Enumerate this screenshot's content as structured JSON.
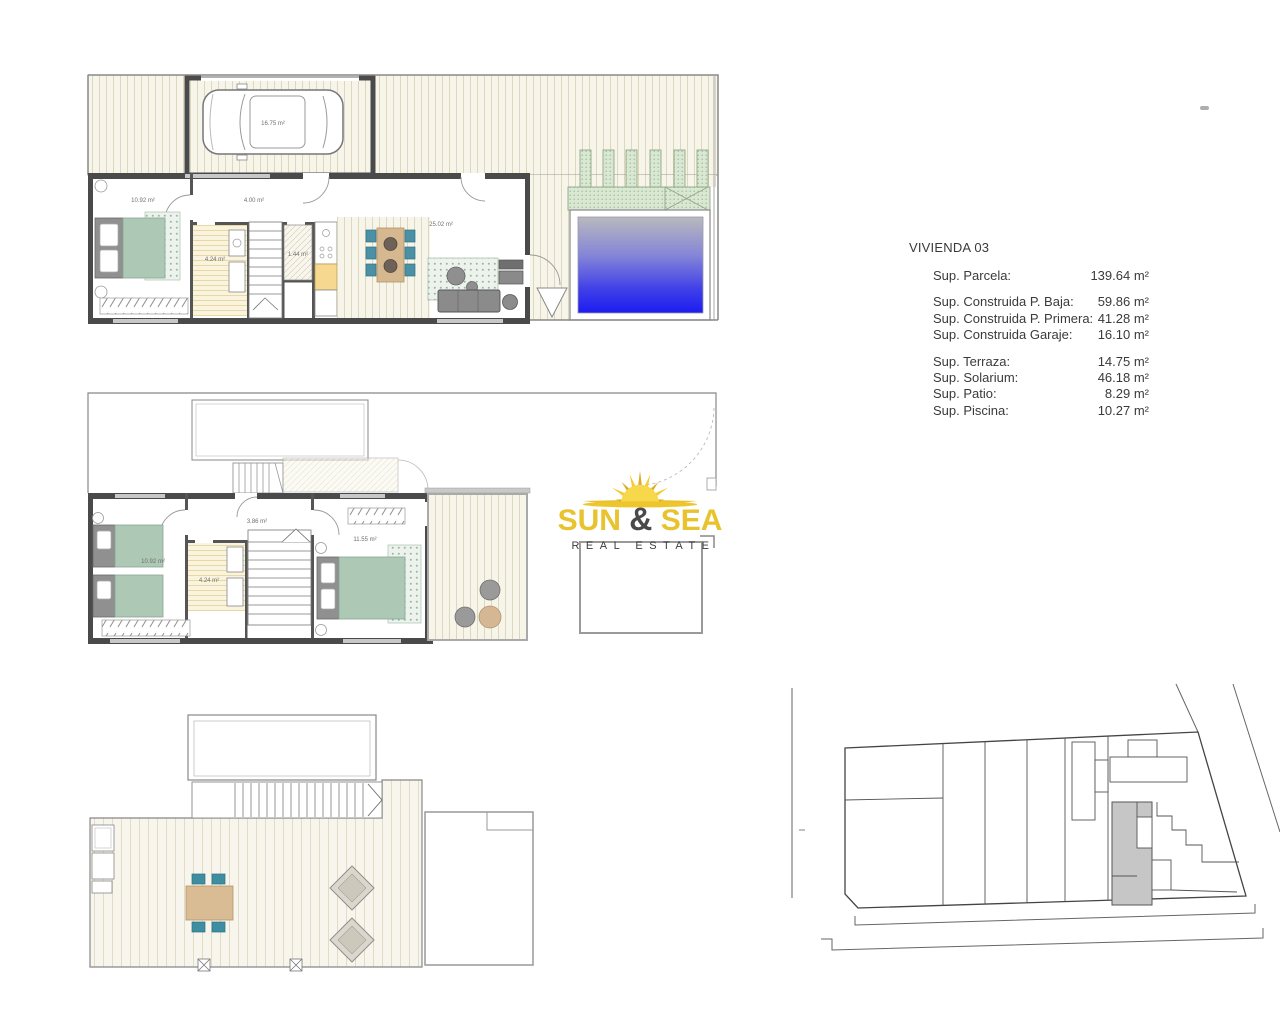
{
  "document": {
    "background": "#ffffff"
  },
  "info_panel": {
    "title": "VIVIENDA 03",
    "rows": [
      {
        "label": "Sup. Parcela:",
        "value": "139.64 m²"
      },
      {
        "label": "Sup. Construida P. Baja:",
        "value": "59.86 m²"
      },
      {
        "label": "Sup. Construida P. Primera:",
        "value": "41.28 m²"
      },
      {
        "label": "Sup. Construida Garaje:",
        "value": "16.10 m²"
      },
      {
        "label": "Sup. Terraza:",
        "value": "14.75 m²"
      },
      {
        "label": "Sup. Solarium:",
        "value": "46.18 m²"
      },
      {
        "label": "Sup. Patio:",
        "value": "8.29 m²"
      },
      {
        "label": "Sup. Piscina:",
        "value": "10.27 m²"
      }
    ]
  },
  "logo": {
    "word1": "SUN",
    "ampersand": "&",
    "word2": "SEA",
    "tagline": "REAL ESTATE",
    "colors": {
      "yellow": "#e8c32d",
      "dark": "#4a4a4a"
    }
  },
  "plans": {
    "ground": {
      "labels": {
        "garage": "16.75 m²",
        "bedroom": "10.92 m²",
        "hall": "4.00 m²",
        "bath": "4.24 m²",
        "wc": "1.44 m²",
        "living": "25.02 m²"
      }
    },
    "first": {
      "labels": {
        "bedroom_left": "10.92 m²",
        "bath": "4.24 m²",
        "hall": "3.86 m²",
        "bedroom_right": "11.55 m²"
      }
    },
    "site": {
      "highlight_color": "#c6c6c6"
    }
  },
  "colors": {
    "pool_top": "#b9b9bd",
    "pool_bottom": "#1c1cf0",
    "vegetation": "#d9e7d3",
    "bed_green": "#adc8b5",
    "chair_teal": "#4b90a5",
    "table_wood": "#d5b88f",
    "wall_dark": "#4a4a4a"
  }
}
